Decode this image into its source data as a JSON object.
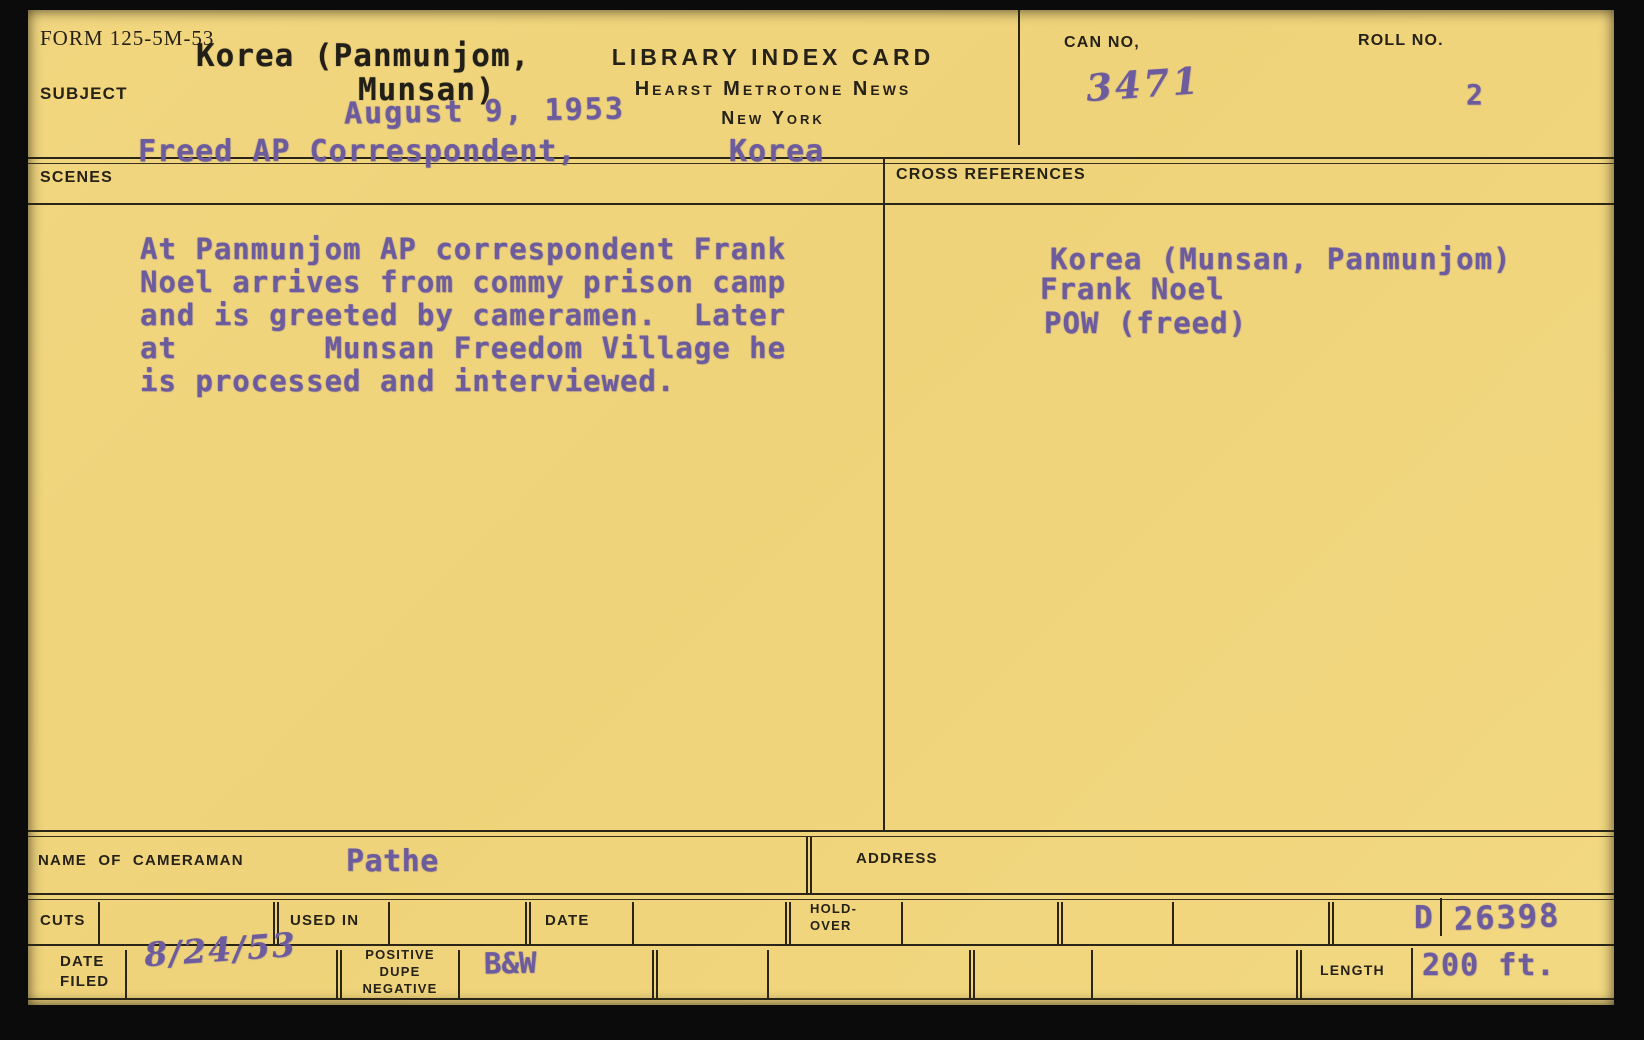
{
  "card": {
    "form_number": "FORM 125-5M-53",
    "header": {
      "subject_label": "SUBJECT",
      "subject_line1": "Korea (Panmunjom,",
      "subject_line2": "Munsan)",
      "date_stamp": "August 9, 1953",
      "title_line1": "LIBRARY INDEX CARD",
      "title_line2": "Hearst Metrotone News",
      "title_line3": "New York",
      "can_no_label": "CAN NO,",
      "can_no_value": "3471",
      "roll_no_label": "ROLL NO.",
      "roll_no_value": "2"
    },
    "crossed_out_title": "Freed AP Correspondent,        Korea",
    "scenes": {
      "label": "SCENES",
      "lines": [
        "At Panmunjom AP correspondent Frank",
        "Noel arrives from commy prison camp",
        "and is greeted by cameramen.  Later",
        "at        Munsan Freedom Village he",
        "is processed and interviewed."
      ]
    },
    "cross_references": {
      "label": "CROSS REFERENCES",
      "line1": "Korea (Munsan, Panmunjom)",
      "line2": "Frank Noel",
      "line3": "POW (freed)"
    },
    "cameraman_row": {
      "name_label": "NAME OF CAMERAMAN",
      "name_value": "Pathe",
      "address_label": "ADDRESS"
    },
    "cuts_row": {
      "cuts_label": "CUTS",
      "used_in_label": "USED IN",
      "date_label": "DATE",
      "holdover_label": "HOLD-\nOVER",
      "d_label": "D",
      "d_value": "26398"
    },
    "filed_row": {
      "date_filed_label": "DATE\nFILED",
      "date_filed_value": "8/24/53",
      "stock_type_label": "POSITIVE\nDUPE\nNEGATIVE",
      "stock_value": "B&W",
      "length_label": "LENGTH",
      "length_value": "200 ft."
    },
    "colors": {
      "card_bg": "#f0d57e",
      "ink_black": "#262218",
      "ink_purple": "#6d5c9d",
      "rule_line": "#2b2517"
    }
  }
}
